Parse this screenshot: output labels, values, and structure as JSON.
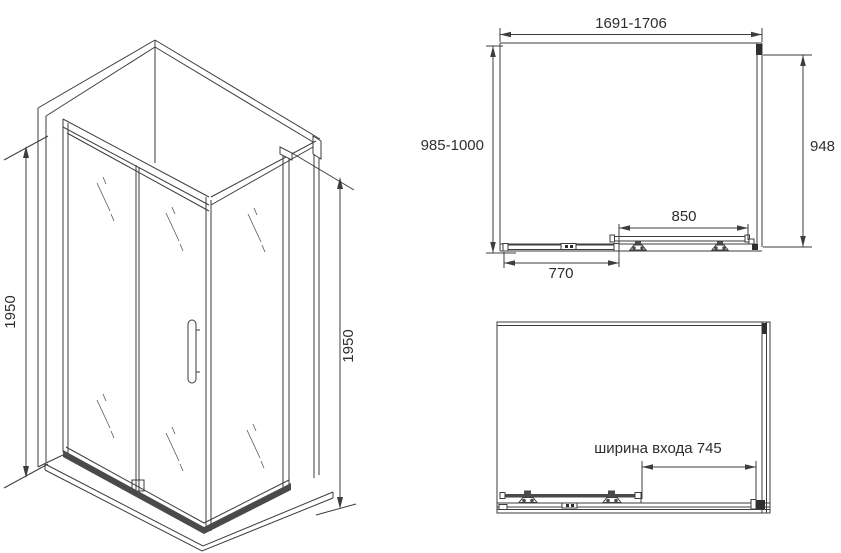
{
  "drawing": {
    "type": "shower-enclosure-technical-drawing",
    "background_color": "#ffffff",
    "line_color": "#3d3d3d",
    "perspective_view": {
      "height_dim_left": "1950",
      "height_dim_right": "1950"
    },
    "top_view": {
      "width_range": "1691-1706",
      "depth_range": "985-1000",
      "side_panel_depth": "948",
      "door_width": "850",
      "fixed_panel_width": "770"
    },
    "front_view": {
      "entrance_width_label": "ширина входа 745"
    }
  }
}
